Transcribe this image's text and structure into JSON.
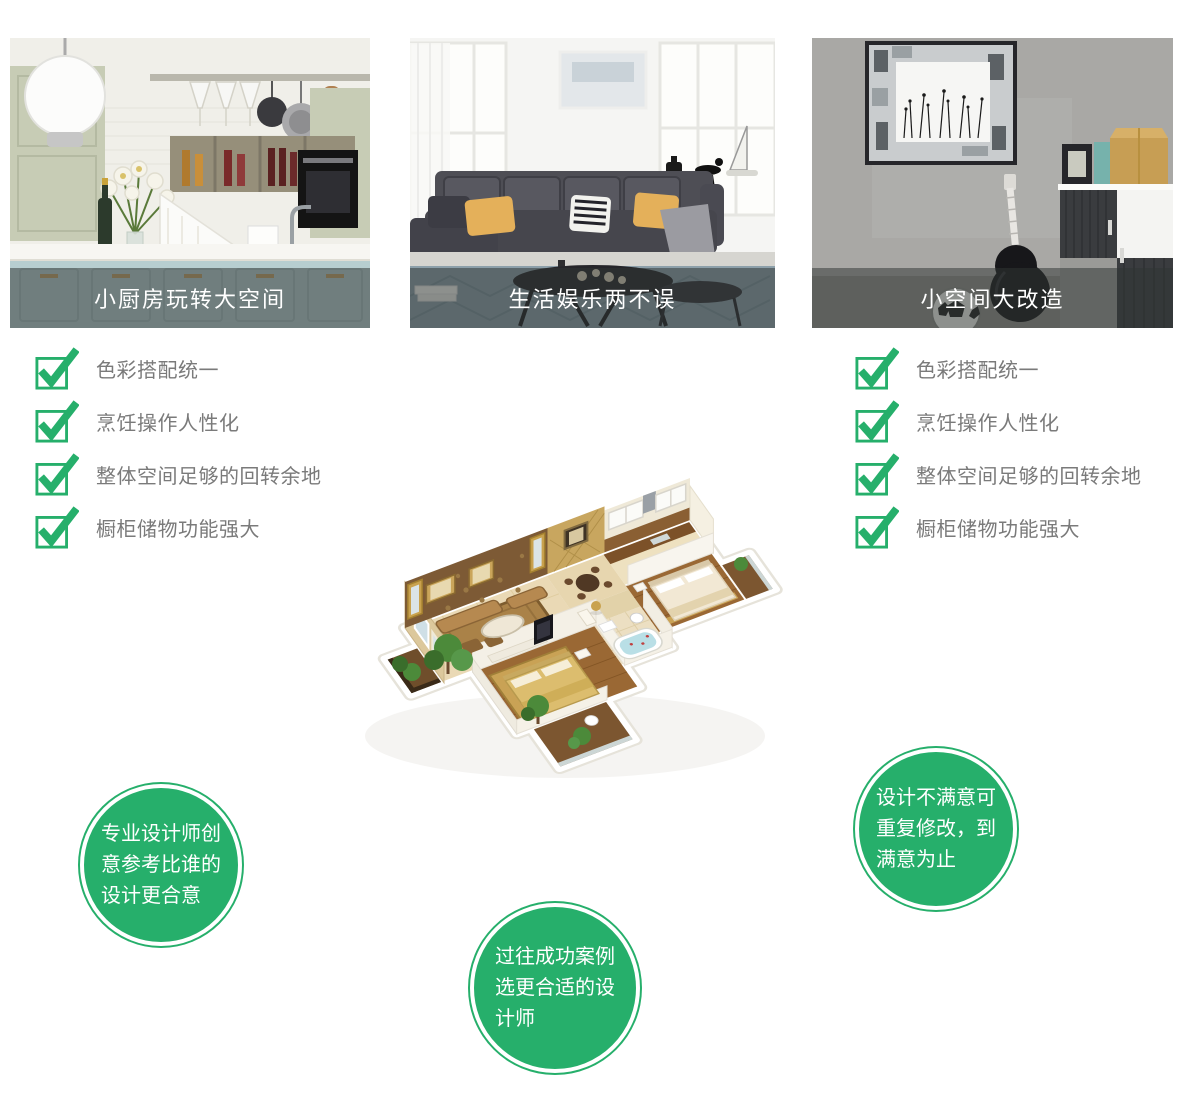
{
  "theme": {
    "accent_green": "#26af6b",
    "checklist_text_gray": "#7a7a7a",
    "caption_overlay": "rgba(47,53,51,0.52)"
  },
  "cards": [
    {
      "caption": "小厨房玩转大空间"
    },
    {
      "caption": "生活娱乐两不误"
    },
    {
      "caption": "小空间大改造"
    }
  ],
  "checklist_left": [
    "色彩搭配统一",
    "烹饪操作人性化",
    "整体空间足够的回转余地",
    "橱柜储物功能强大"
  ],
  "checklist_right": [
    "色彩搭配统一",
    "烹饪操作人性化",
    "整体空间足够的回转余地",
    "橱柜储物功能强大"
  ],
  "bubbles": {
    "left": [
      "专业设计师创",
      "意参考比谁的",
      "设计更合意"
    ],
    "bottom": [
      "过往成功案例",
      "选更合适的设",
      "计师"
    ],
    "right": [
      "设计不满意可",
      "重复修改，到",
      "满意为止"
    ]
  }
}
